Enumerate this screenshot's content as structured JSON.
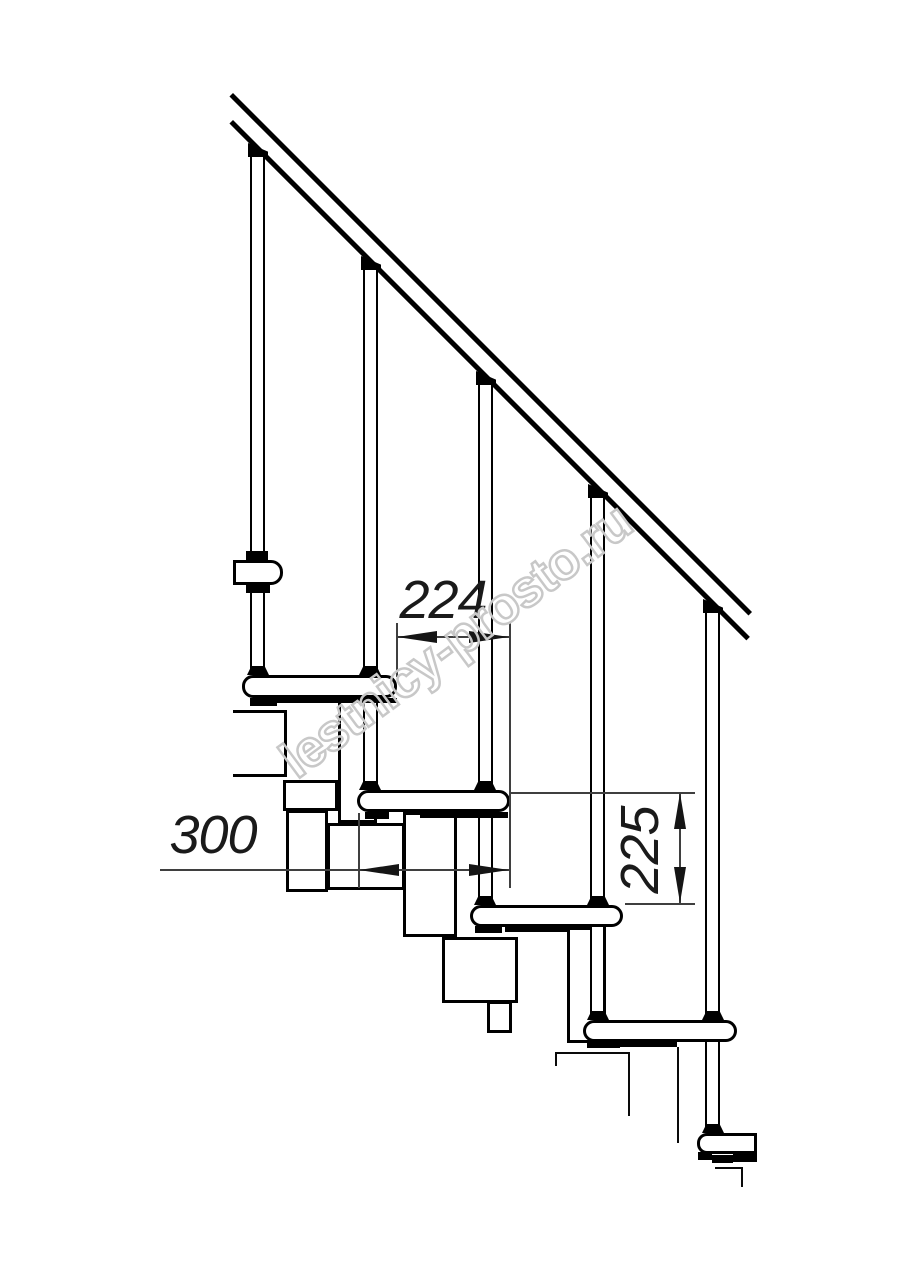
{
  "watermark": {
    "text": "lestnicy-prosto.ru",
    "color": "#c8c8c8"
  },
  "annotations": {
    "dim_going": {
      "value": "224"
    },
    "dim_tread_length": {
      "value": "300"
    },
    "dim_rise": {
      "value": "225"
    }
  },
  "drawing": {
    "background": "#ffffff",
    "line_color": "#000000",
    "dim_line_color": "#3f3f3f"
  }
}
